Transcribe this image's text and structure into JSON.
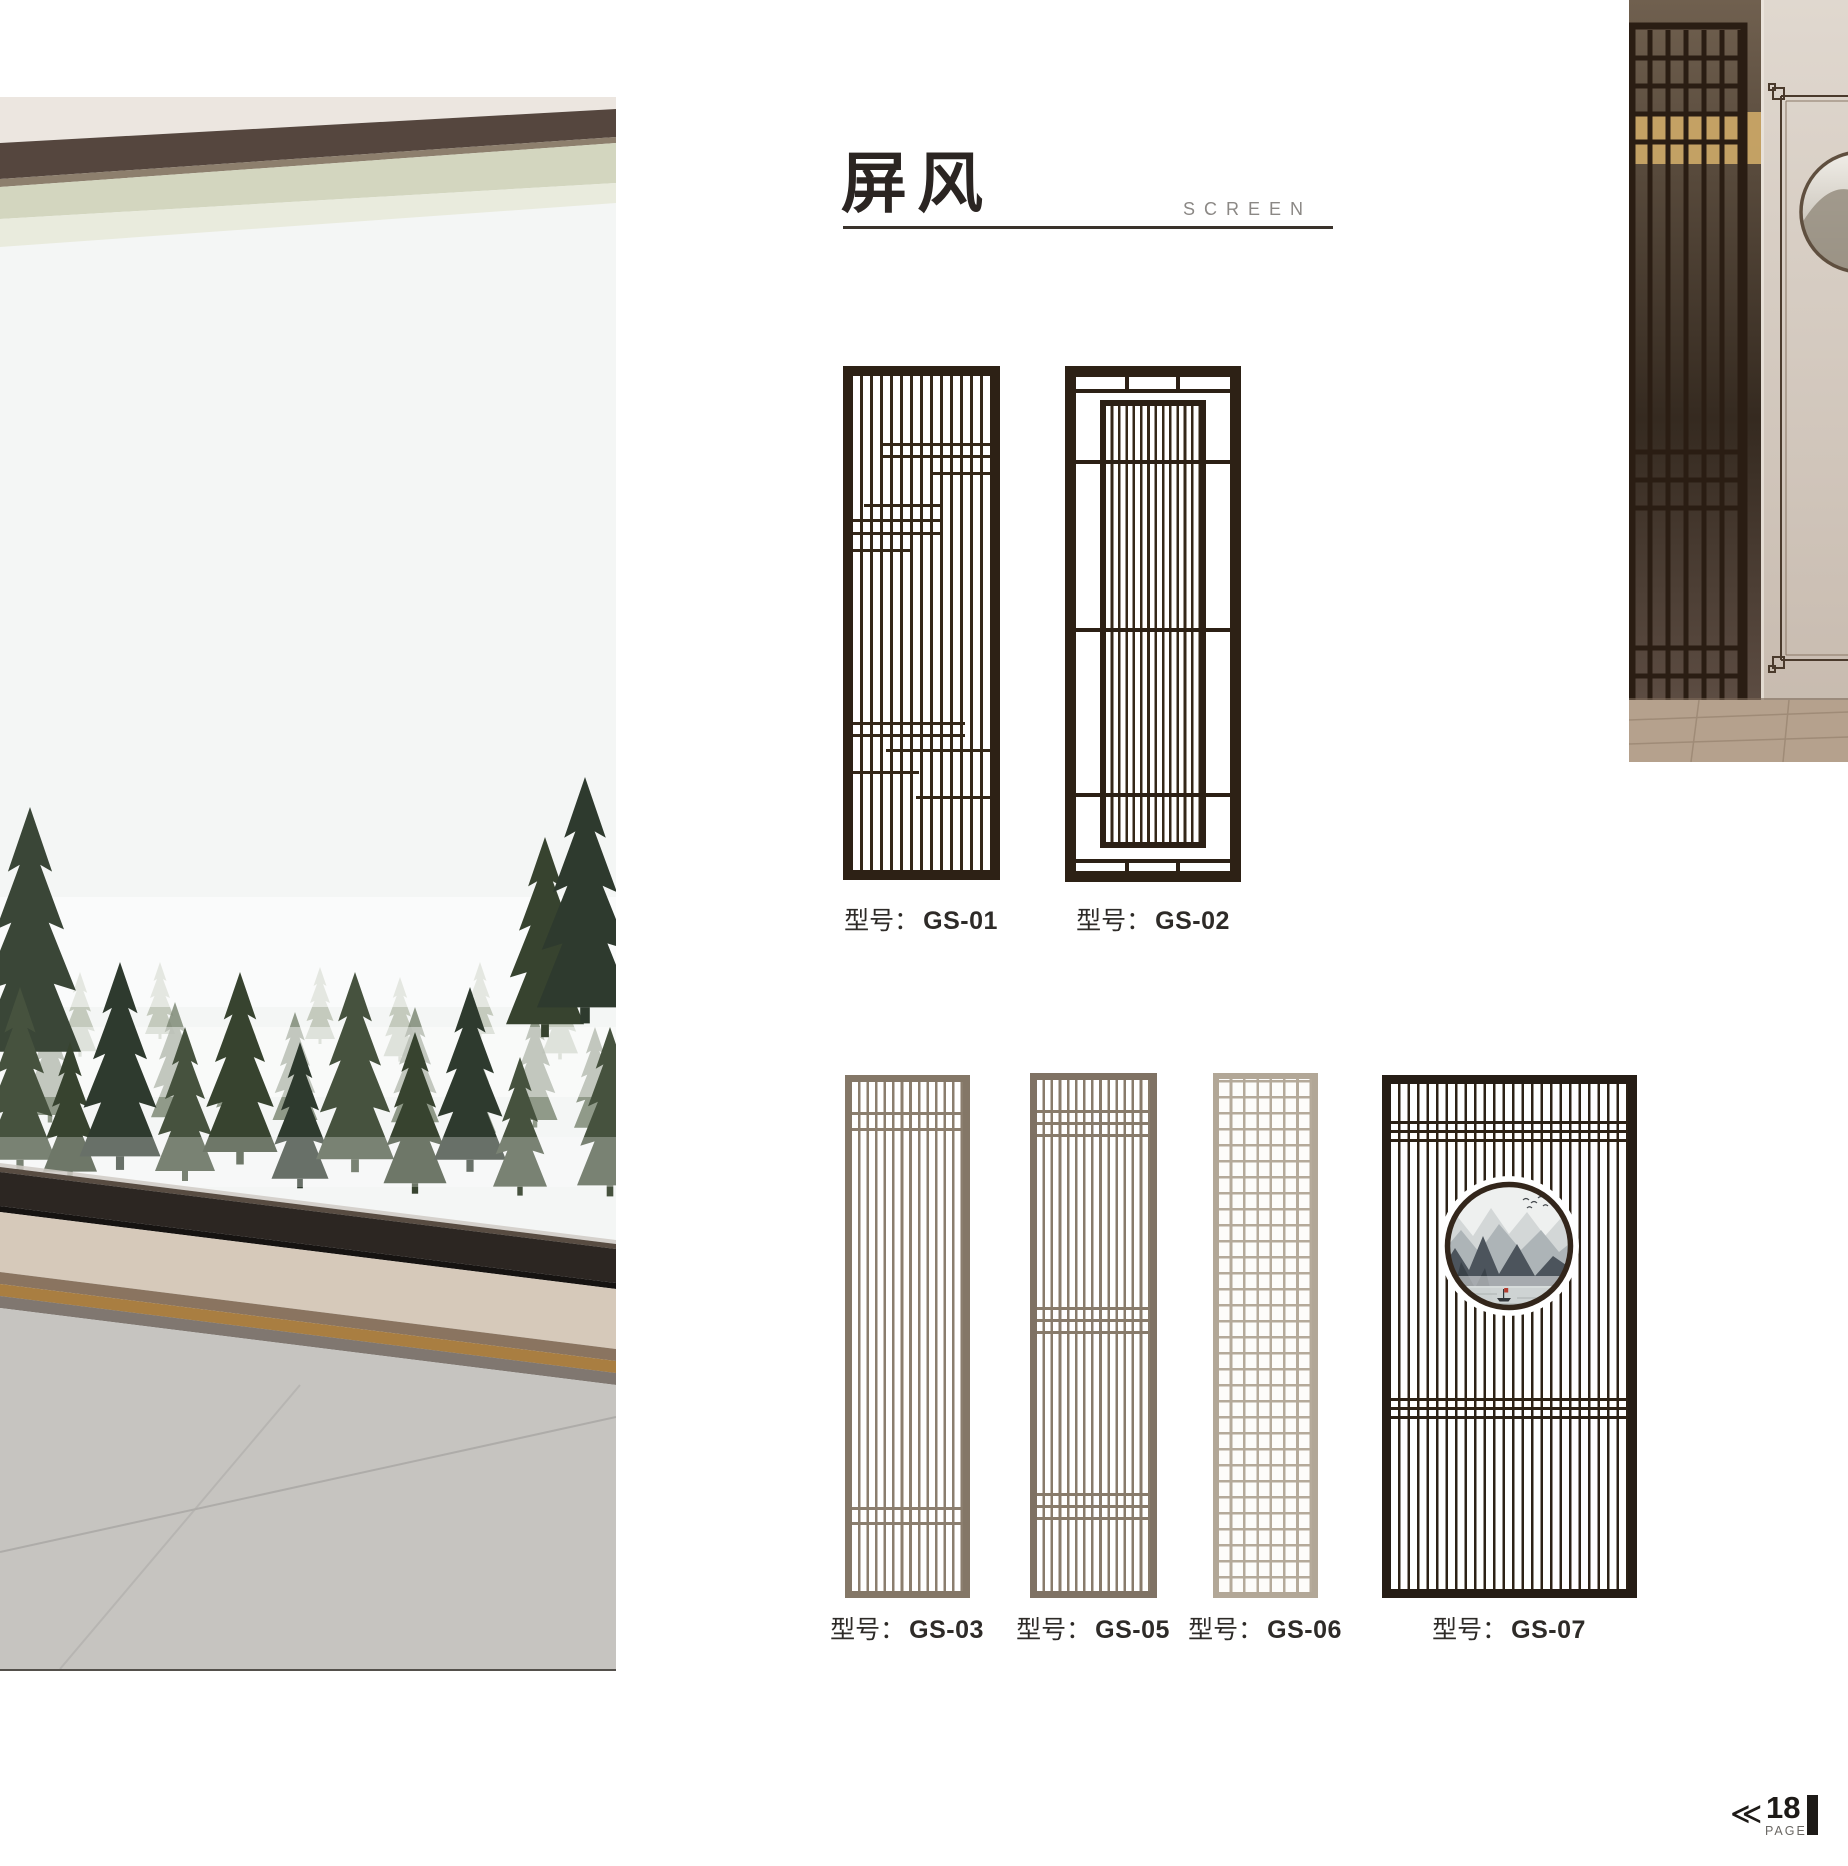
{
  "header": {
    "title_cn": "屏风",
    "title_en": "SCREEN"
  },
  "products": [
    {
      "prefix": "型号：",
      "model": "GS-01"
    },
    {
      "prefix": "型号：",
      "model": "GS-02"
    },
    {
      "prefix": "型号：",
      "model": "GS-03"
    },
    {
      "prefix": "型号：",
      "model": "GS-05"
    },
    {
      "prefix": "型号：",
      "model": "GS-06"
    },
    {
      "prefix": "型号：",
      "model": "GS-07"
    }
  ],
  "footer": {
    "prev_icon": "≪",
    "page_number": "18",
    "page_label": "PAGE"
  },
  "colors": {
    "dark_wood": "#2d2115",
    "greige_wood": "#847767",
    "light_wood": "#b2a797",
    "glow_amber": "#c9a566",
    "title_ink": "#2b2522",
    "subtitle_gray": "#8b8885",
    "rule_line": "#3a332c",
    "boat_flag_red": "#b43b2e"
  }
}
